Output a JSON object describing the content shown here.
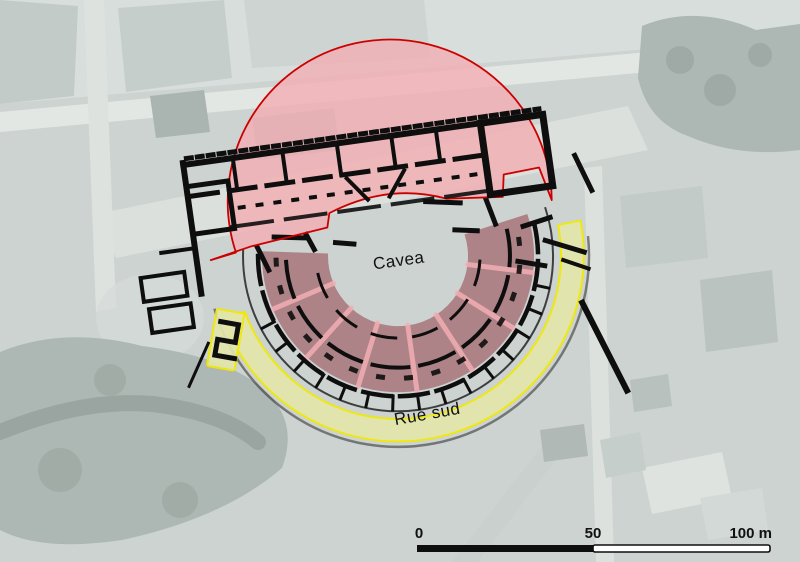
{
  "map": {
    "labels": {
      "cavea": "Cavea",
      "rue_sud": "Rue sud"
    },
    "scale_bar": {
      "tick_0": "0",
      "tick_50": "50",
      "tick_100": "100 m"
    },
    "colors": {
      "cavea_fill": "#f2aeb3",
      "cavea_outline": "#cc0000",
      "seating_fill": "#aa7c80",
      "street_band_fill": "#e3e6ab",
      "street_band_outline": "#f2ea00",
      "plan_black": "#0e0e0e",
      "photo_base": "#ccd3d1"
    }
  }
}
